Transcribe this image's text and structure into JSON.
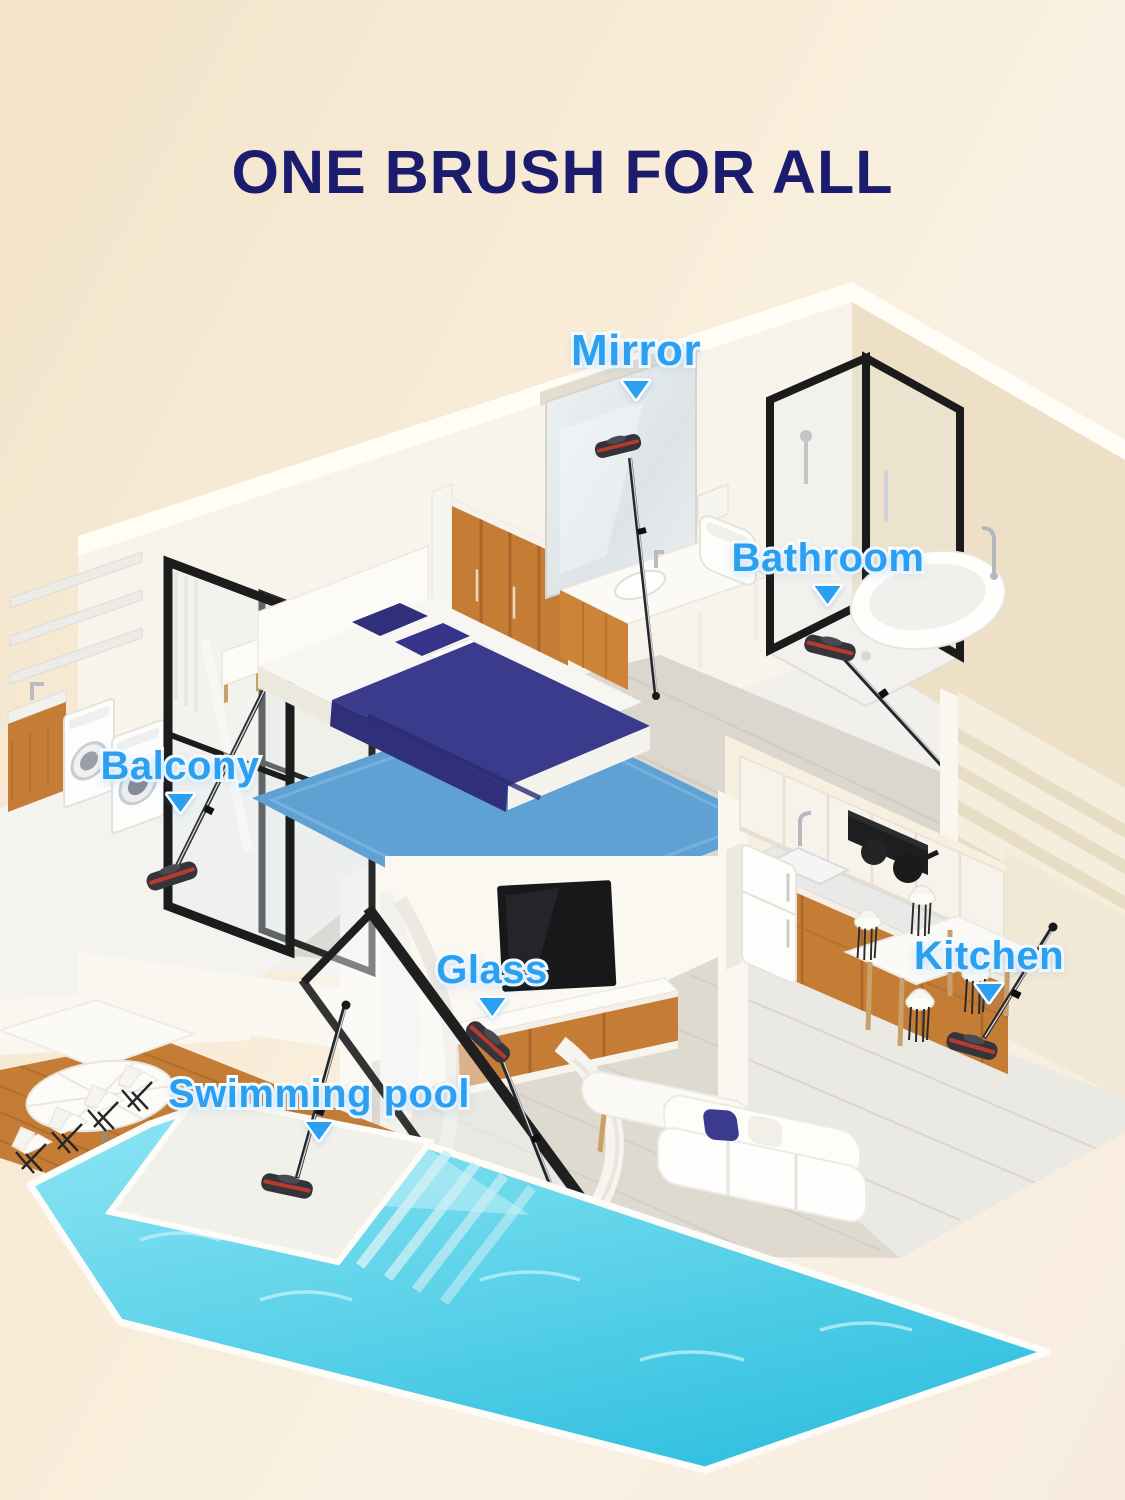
{
  "title": {
    "text": "ONE BRUSH FOR ALL"
  },
  "annotations": {
    "arrow_glyph": "▼",
    "labels": [
      {
        "id": "mirror",
        "text": "Mirror"
      },
      {
        "id": "bathroom",
        "text": "Bathroom"
      },
      {
        "id": "balcony",
        "text": "Balcony"
      },
      {
        "id": "glass",
        "text": "Glass"
      },
      {
        "id": "swimming-pool",
        "text": "Swimming pool"
      },
      {
        "id": "kitchen",
        "text": "Kitchen"
      }
    ]
  },
  "colors": {
    "bg-top": "#f3e3c9",
    "bg-mid": "#f8edd9",
    "bg-bottom": "#f7ecdf",
    "title-navy": "#1c1c6e",
    "label-blue": "#2b9ff0",
    "label-outline": "#ffffff",
    "wood": "#c57d35",
    "wood-dark": "#a9682a",
    "wall-cream": "#ede0c7",
    "wall-white": "#f8f4eb",
    "floor-grey": "#dbd7ce",
    "rug-blue": "#60a1d4",
    "bedding-navy": "#3b3b8e",
    "frame-black": "#1f1f1f",
    "pool-light": "#8ee6f4",
    "pool-deep": "#35c2e0",
    "mop-red": "#c43b2e"
  }
}
